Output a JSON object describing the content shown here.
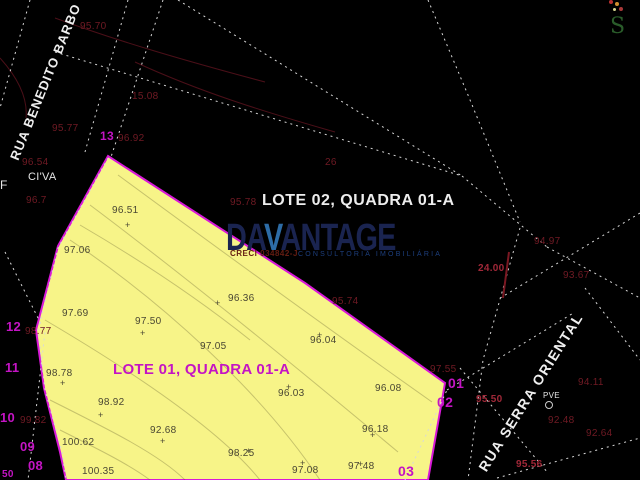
{
  "streets": [
    {
      "name": "RUA BENEDITO BARBO"
    },
    {
      "name": "RUA SERRA ORIENTAL"
    }
  ],
  "lot_labels": [
    {
      "text": "LOTE 02, QUADRA 01-A"
    },
    {
      "text": "LOTE 01, QUADRA 01-A"
    }
  ],
  "watermark": {
    "brand_start": "DA",
    "brand_v": "V",
    "brand_end": "ANTAGE",
    "creci": "CRECI 034842-J",
    "tagline": "CONSULTORIA IMOBILIÁRIA"
  },
  "compass_letter": "S",
  "colors": {
    "background": "#000000",
    "parcel_fill": "#f7f488",
    "parcel_outline": "#d818d8",
    "magenta_label": "#c414c4",
    "dark_red_label": "#701a24",
    "bright_red_label": "#a02838",
    "watermark_navy": "#1a2450",
    "watermark_blue": "#2d6ca6",
    "dotted_line": "#d8d8d8"
  },
  "points": [
    {
      "t": "96.51",
      "x": 112,
      "y": 206,
      "c": "dk"
    },
    {
      "t": "97.06",
      "x": 64,
      "y": 246,
      "c": "dk"
    },
    {
      "t": "96.36",
      "x": 228,
      "y": 294,
      "c": "dk"
    },
    {
      "t": "97.69",
      "x": 62,
      "y": 309,
      "c": "dk"
    },
    {
      "t": "97.50",
      "x": 135,
      "y": 317,
      "c": "dk"
    },
    {
      "t": "97.05",
      "x": 200,
      "y": 342,
      "c": "dk"
    },
    {
      "t": "96.04",
      "x": 310,
      "y": 336,
      "c": "dk"
    },
    {
      "t": "98.78",
      "x": 46,
      "y": 369,
      "c": "dk"
    },
    {
      "t": "96.03",
      "x": 278,
      "y": 389,
      "c": "dk"
    },
    {
      "t": "96.08",
      "x": 375,
      "y": 384,
      "c": "dk"
    },
    {
      "t": "98.92",
      "x": 98,
      "y": 398,
      "c": "dk"
    },
    {
      "t": "100.62",
      "x": 62,
      "y": 438,
      "c": "dk"
    },
    {
      "t": "92.68",
      "x": 150,
      "y": 426,
      "c": "dk"
    },
    {
      "t": "100.35",
      "x": 82,
      "y": 467,
      "c": "dk"
    },
    {
      "t": "98.25",
      "x": 228,
      "y": 449,
      "c": "dk"
    },
    {
      "t": "97.08",
      "x": 292,
      "y": 466,
      "c": "dk"
    },
    {
      "t": "97.48",
      "x": 348,
      "y": 462,
      "c": "dk"
    },
    {
      "t": "96.18",
      "x": 362,
      "y": 425,
      "c": "dk"
    },
    {
      "t": "95.70",
      "x": 80,
      "y": 22,
      "c": "red"
    },
    {
      "t": "15.08",
      "x": 132,
      "y": 92,
      "c": "red"
    },
    {
      "t": "95.77",
      "x": 52,
      "y": 124,
      "c": "red"
    },
    {
      "t": "96.92",
      "x": 118,
      "y": 134,
      "c": "red"
    },
    {
      "t": "96.54",
      "x": 22,
      "y": 158,
      "c": "red"
    },
    {
      "t": "96.7",
      "x": 26,
      "y": 196,
      "c": "red"
    },
    {
      "t": "95.78",
      "x": 230,
      "y": 198,
      "c": "red"
    },
    {
      "t": "26",
      "x": 325,
      "y": 158,
      "c": "red"
    },
    {
      "t": "95.74",
      "x": 332,
      "y": 297,
      "c": "red"
    },
    {
      "t": "98.77",
      "x": 25,
      "y": 327,
      "c": "red"
    },
    {
      "t": "99.82",
      "x": 20,
      "y": 416,
      "c": "red"
    },
    {
      "t": "94.97",
      "x": 534,
      "y": 237,
      "c": "red"
    },
    {
      "t": "93.67",
      "x": 563,
      "y": 271,
      "c": "red"
    },
    {
      "t": "94.11",
      "x": 578,
      "y": 378,
      "c": "red"
    },
    {
      "t": "92.48",
      "x": 548,
      "y": 416,
      "c": "red"
    },
    {
      "t": "92.64",
      "x": 586,
      "y": 429,
      "c": "red"
    },
    {
      "t": "97.55",
      "x": 430,
      "y": 365,
      "c": "red"
    },
    {
      "t": "24.00",
      "x": 478,
      "y": 264,
      "c": "red2"
    },
    {
      "t": "95.50",
      "x": 476,
      "y": 395,
      "c": "red2"
    },
    {
      "t": "95.56",
      "x": 516,
      "y": 460,
      "c": "red2"
    },
    {
      "t": "13",
      "x": 100,
      "y": 130,
      "c": "mag",
      "fs": 12
    },
    {
      "t": "12",
      "x": 6,
      "y": 320,
      "c": "mag"
    },
    {
      "t": "11",
      "x": 5,
      "y": 361,
      "c": "mag"
    },
    {
      "t": "10",
      "x": 0,
      "y": 411,
      "c": "mag"
    },
    {
      "t": "09",
      "x": 20,
      "y": 440,
      "c": "mag"
    },
    {
      "t": "08",
      "x": 28,
      "y": 459,
      "c": "mag"
    },
    {
      "t": "01",
      "x": 448,
      "y": 376,
      "c": "mag",
      "fs": 14
    },
    {
      "t": "02",
      "x": 437,
      "y": 395,
      "c": "mag",
      "fs": 14
    },
    {
      "t": "03",
      "x": 398,
      "y": 464,
      "c": "mag",
      "fs": 14
    },
    {
      "t": "50",
      "x": 2,
      "y": 470,
      "c": "mag",
      "fs": 10
    },
    {
      "t": "PVE",
      "x": 543,
      "y": 392,
      "c": "wht",
      "fs": 8
    },
    {
      "t": "CI'VA",
      "x": 28,
      "y": 172,
      "c": "wht",
      "fs": 11
    },
    {
      "t": "F",
      "x": 0,
      "y": 179,
      "c": "wht",
      "fs": 12
    }
  ],
  "markers": [
    {
      "x": 125,
      "y": 221
    },
    {
      "x": 317,
      "y": 331
    },
    {
      "x": 286,
      "y": 383
    },
    {
      "x": 98,
      "y": 411
    },
    {
      "x": 160,
      "y": 437
    },
    {
      "x": 300,
      "y": 459
    },
    {
      "x": 370,
      "y": 431
    },
    {
      "x": 140,
      "y": 329
    },
    {
      "x": 215,
      "y": 299
    },
    {
      "x": 60,
      "y": 379
    },
    {
      "x": 246,
      "y": 447
    },
    {
      "x": 358,
      "y": 460
    }
  ],
  "dots": [
    {
      "x": 611,
      "y": 2,
      "r": 2,
      "fill": "#b83030"
    },
    {
      "x": 617,
      "y": 4,
      "r": 2,
      "fill": "#d09030"
    },
    {
      "x": 621,
      "y": 9,
      "r": 2,
      "fill": "#a83838"
    },
    {
      "x": 614,
      "y": 9,
      "r": 1.5,
      "fill": "#d8d890"
    },
    {
      "x": 548,
      "y": 404,
      "r": 3,
      "ring": "#cccccc"
    }
  ],
  "geometry": {
    "parcel_polygon": "108,156 305,283 445,383 428,480 66,480 60,452 44,388 36,330 58,246",
    "dotted_lines": [
      {
        "pts": "30,0 0,108"
      },
      {
        "pts": "128,0 85,152"
      },
      {
        "pts": "163,0 110,160"
      },
      {
        "pts": "55,52 462,176"
      },
      {
        "pts": "462,176 547,247"
      },
      {
        "pts": "178,0 462,176"
      },
      {
        "pts": "428,0 468,95 520,222"
      },
      {
        "pts": "520,228 483,360 468,480"
      },
      {
        "pts": "547,247 640,298"
      },
      {
        "pts": "640,213 497,300"
      },
      {
        "pts": "447,390 575,312"
      },
      {
        "pts": "460,368 548,473"
      },
      {
        "pts": "585,288 640,360"
      },
      {
        "pts": "497,478 640,438"
      },
      {
        "pts": "5,252 45,332 28,480"
      },
      {
        "pts": "405,480 447,390"
      },
      {
        "pts": "108,158 58,248 38,330 45,390 62,452 66,480"
      }
    ],
    "red_line": {
      "x1": 509,
      "y1": 252,
      "x2": 503,
      "y2": 298
    },
    "contours_yellow": [
      "M70,240 C160,300 260,390 320,480",
      "M45,320 C130,370 220,430 260,480",
      "M50,400 C110,430 160,455 185,480",
      "M118,175 C220,250 330,330 432,402",
      "M90,205 C190,280 300,370 398,452",
      "M60,430 C100,450 130,465 150,480",
      "M80,225 C140,260 200,300 250,340"
    ],
    "contours_black": [
      "M55,18 C120,42 190,62 265,82",
      "M135,62 C200,92 265,112 335,132",
      "M0,58 C18,78 28,98 26,118"
    ]
  }
}
